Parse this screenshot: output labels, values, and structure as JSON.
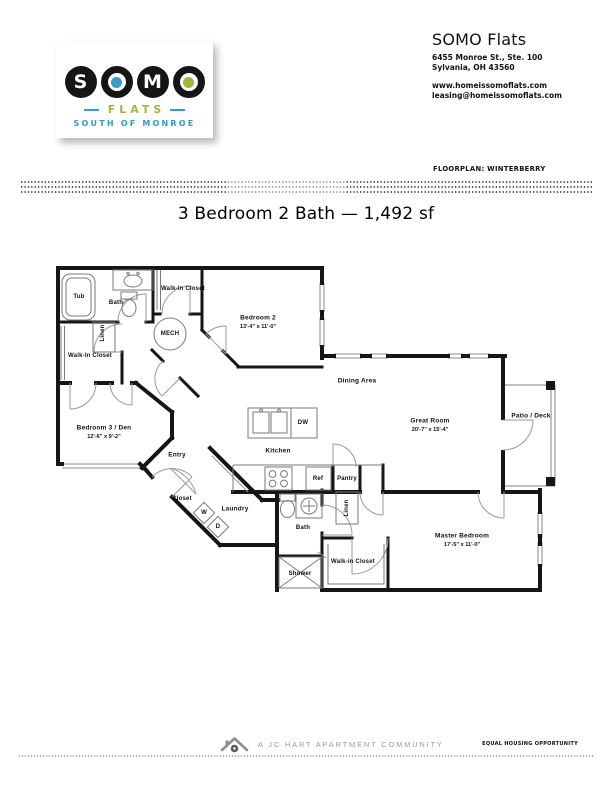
{
  "logo": {
    "name_letters": [
      "S",
      "O",
      "M",
      "O"
    ],
    "flats": "FLATS",
    "tagline": "SOUTH OF MONROE",
    "colors": {
      "blue": "#3a9dc8",
      "olive": "#a8b43a",
      "black": "#151515"
    }
  },
  "header": {
    "name": "SOMO Flats",
    "address_line1": "6455 Monroe St., Ste. 100",
    "address_line2": "Sylvania, OH 43560",
    "website": "www.homeissomoflats.com",
    "email": "leasing@homeissomoflats.com"
  },
  "floorplan_label": "FLOORPLAN: WINTERBERRY",
  "title": "3 Bedroom 2 Bath — 1,492 sf",
  "plan": {
    "labels": {
      "tub": "Tub",
      "bath_upper": "Bath",
      "walkin_closet_upper": "Walk-In Closet",
      "linen_upper": "Linen",
      "mech": "MECH",
      "walkin_closet_left": "Walk-In Closet",
      "bedroom2": "Bedroom 2",
      "bedroom2_dims": "13'-4\" x 11'-0\"",
      "dining": "Dining Area",
      "great_room": "Great Room",
      "great_room_dims": "20'-7\" x 15'-4\"",
      "patio": "Patio / Deck",
      "bedroom3": "Bedroom 3 / Den",
      "bedroom3_dims": "12'-6\" x 9'-2\"",
      "entry": "Entry",
      "kitchen": "Kitchen",
      "dw": "DW",
      "ref": "Ref",
      "pantry": "Pantry",
      "closet": "Closet",
      "laundry": "Laundry",
      "washer": "W",
      "dryer": "D",
      "linen_lower": "Linen",
      "bath_lower": "Bath",
      "shower": "Shower",
      "walkin_closet_master": "Walk-in Closet",
      "master": "Master Bedroom",
      "master_dims": "17'-5\" x 11'-0\""
    }
  },
  "footer": {
    "community_label": "A JC HART APARTMENT COMMUNITY",
    "eho_label": "EQUAL HOUSING OPPORTUNITY"
  }
}
